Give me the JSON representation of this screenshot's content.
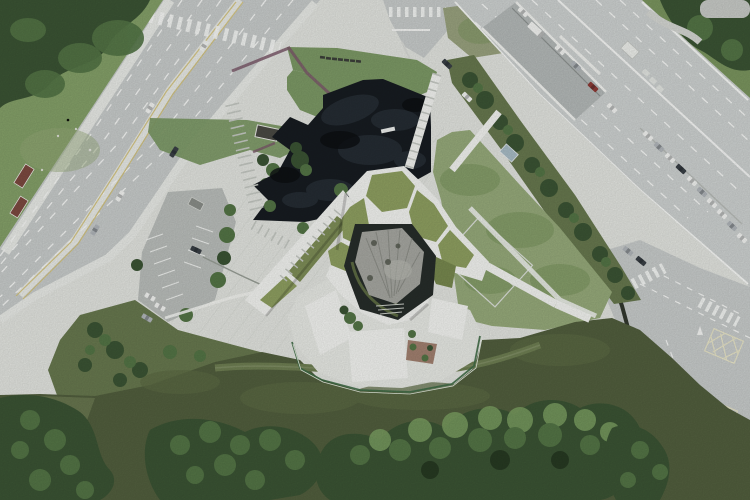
{
  "meta": {
    "title": "Aerial photograph — angular green-roof pavilion with black pond, plaza and roads",
    "view": "top-down drone view",
    "image_size": "750x500"
  },
  "colors": {
    "plaza": "#e4e6e1",
    "road": "#c9cdcc",
    "highway": "#cfd3d2",
    "underpass": "#b5bab9",
    "median": "#eaece8",
    "laneWhite": "#fafbf9",
    "laneYellow": "#d6c57c",
    "grassBright": "#85a169",
    "grassMid": "#7b965f",
    "grassLight": "#97ab7b",
    "lawn": "#7d9a66",
    "meadow": "#525f3e",
    "scrub": "#68794f",
    "treeDark": "#3b5434",
    "treeMid": "#547546",
    "treeLight": "#799c60",
    "pond": "#171c21",
    "pondMottle": "#2a323a",
    "roofGreen": "#8fa061",
    "roofGreenDark": "#78894f",
    "white": "#f4f5f2",
    "softWhite": "#e9ebe6",
    "rock": "#a7a8a2",
    "rockShadow": "#83857e",
    "terrace": "#272d2a",
    "purple": "#7c5a6b",
    "wall": "#32382e",
    "fence": "#3f6b46",
    "parkingLot": "#bbbfbc",
    "shedRed": "#7d4a40",
    "shedBlue": "#a9bdc7",
    "kiosk": "#4a4a44",
    "island": "#9aa37f",
    "patioRed": "#8a5d48",
    "carWhite": "#f4f5f3",
    "carDark": "#3a4046",
    "carRed": "#8e3a35",
    "carGrey": "#b2b7bb",
    "pavingLine": "#d6d9d3",
    "tick": "#c6cac4",
    "trail": "#6f7f53",
    "sand": "#b9b29b",
    "stepGreen": "#5d6b43",
    "stepDark": "#252b28"
  },
  "scene": {
    "type": "aerial-photograph",
    "subject": "Angular cultural pavilion with olive green roof ring around a central rock-garden courtyard, black angular reflecting pond, white paved plaza, triangular lawn, boulevard, elevated road with underpass, junction with hatched boxes, parking lot, meadow and tree canopy",
    "regions": [
      {
        "id": "boulevard",
        "label": "multi-lane boulevard, upper left"
      },
      {
        "id": "top-left-grass",
        "label": "grass and tree grove, top left corner"
      },
      {
        "id": "plaza",
        "label": "white paved plaza"
      },
      {
        "id": "lawn",
        "label": "triangular lawn with bench row and purple edge band"
      },
      {
        "id": "pond",
        "label": "black angular reflecting pond"
      },
      {
        "id": "building",
        "label": "green-roof ring building with rock courtyard and white south roofs"
      },
      {
        "id": "highway",
        "label": "elevated road with underpass ramp, upper right"
      },
      {
        "id": "junction",
        "label": "signalised junction with hatched boxes, lower right"
      },
      {
        "id": "parking",
        "label": "surface parking lot, mid left"
      },
      {
        "id": "east-grass",
        "label": "light grass slope east of building"
      },
      {
        "id": "meadow",
        "label": "dark meadow and dense tree canopy, bottom"
      }
    ],
    "counts": {
      "benches_on_lawn": 7,
      "hatched_junction_boxes": 2,
      "cars_queued_along_highway": 10,
      "red_roof_sheds": 2,
      "green_roof_panels": 6
    }
  }
}
